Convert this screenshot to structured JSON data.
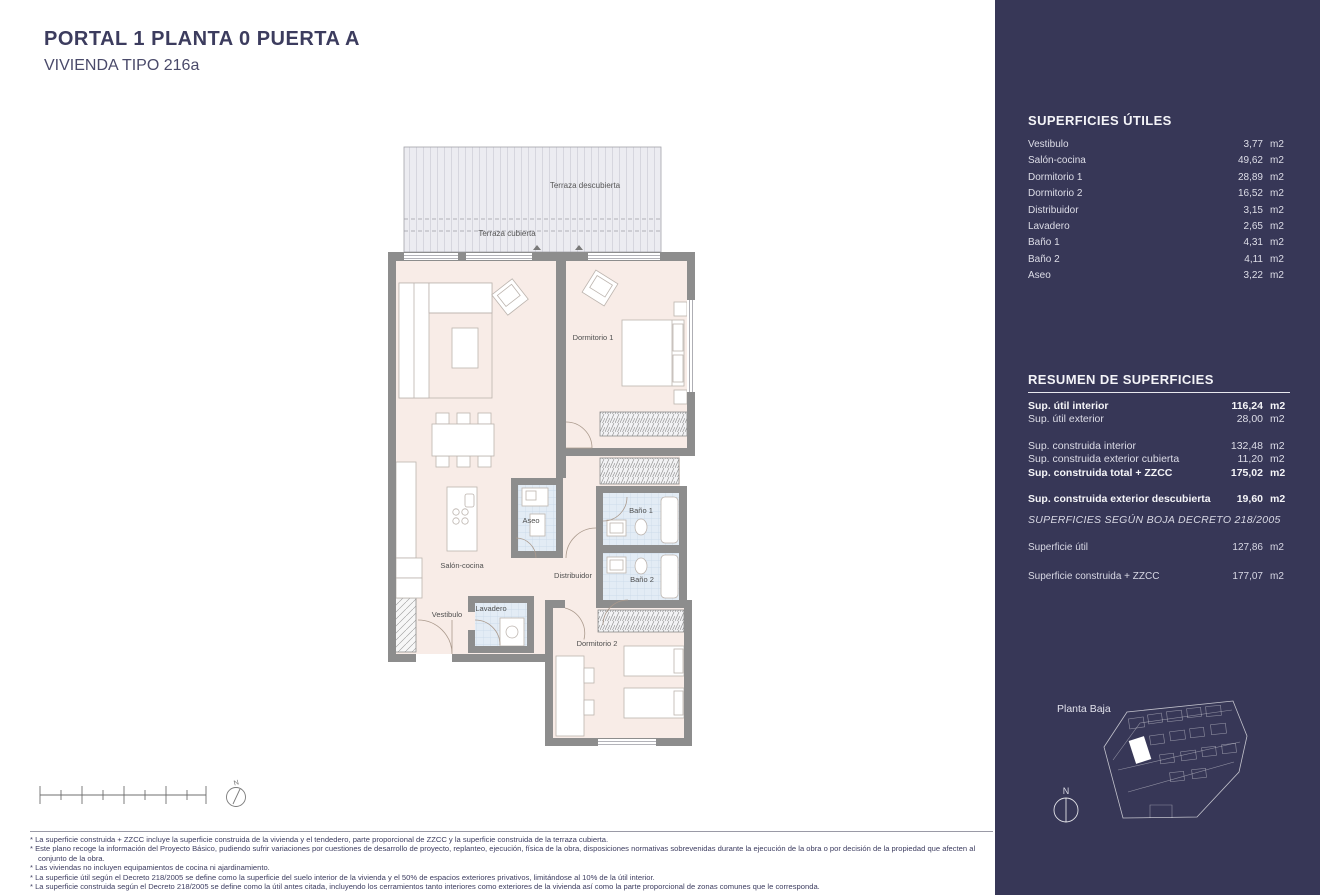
{
  "header": {
    "title": "PORTAL 1  PLANTA 0 PUERTA A",
    "subtitle": "VIVIENDA TIPO 216a"
  },
  "plan": {
    "labels": {
      "terraza_descubierta": "Terraza descubierta",
      "terraza_cubierta": "Terraza cubierta",
      "salon_cocina": "Salón-cocina",
      "dormitorio1": "Dormitorio 1",
      "dormitorio2": "Dormitorio 2",
      "distribuidor": "Distribuidor",
      "bano1": "Baño 1",
      "bano2": "Baño 2",
      "aseo": "Aseo",
      "vestibulo": "Vestibulo",
      "lavadero": "Lavadero"
    },
    "compass_n": "N"
  },
  "sidebar": {
    "superficies_utiles": {
      "title": "SUPERFICIES ÚTILES",
      "rows": [
        {
          "label": "Vestibulo",
          "value": "3,77",
          "unit": "m2"
        },
        {
          "label": "Salón-cocina",
          "value": "49,62",
          "unit": "m2"
        },
        {
          "label": "Dormitorio 1",
          "value": "28,89",
          "unit": "m2"
        },
        {
          "label": "Dormitorio 2",
          "value": "16,52",
          "unit": "m2"
        },
        {
          "label": "Distribuidor",
          "value": "3,15",
          "unit": "m2"
        },
        {
          "label": "Lavadero",
          "value": "2,65",
          "unit": "m2"
        },
        {
          "label": "Baño 1",
          "value": "4,31",
          "unit": "m2"
        },
        {
          "label": "Baño 2",
          "value": "4,11",
          "unit": "m2"
        },
        {
          "label": "Aseo",
          "value": "3,22",
          "unit": "m2"
        }
      ]
    },
    "resumen": {
      "title": "RESUMEN DE SUPERFICIES",
      "rows": [
        {
          "label": "Sup. útil interior",
          "value": "116,24",
          "unit": "m2"
        },
        {
          "label": "Sup. útil exterior",
          "value": "28,00",
          "unit": "m2"
        },
        {
          "label": "Sup. construida interior",
          "value": "132,48",
          "unit": "m2"
        },
        {
          "label": "Sup. construida exterior cubierta",
          "value": "11,20",
          "unit": "m2"
        },
        {
          "label": "Sup. construida total + ZZCC",
          "value": "175,02",
          "unit": "m2"
        }
      ],
      "descubierta": {
        "label": "Sup. construida exterior descubierta",
        "value": "19,60",
        "unit": "m2"
      }
    },
    "boja": {
      "title": "SUPERFICIES SEGÚN BOJA DECRETO 218/2005",
      "rows": [
        {
          "label": "Superficie útil",
          "value": "127,86",
          "unit": "m2"
        },
        {
          "label": "Superficie construida + ZZCC",
          "value": "177,07",
          "unit": "m2"
        }
      ]
    },
    "minimap": {
      "label": "Planta Baja",
      "compass_n": "N"
    }
  },
  "footnotes": [
    "* La superficie construida + ZZCC incluye la superficie construida de la vivienda y el tendedero, parte proporcional de ZZCC y la superficie construida de la terraza cubierta.",
    "* Este plano recoge la información del Proyecto Básico, pudiendo sufrir variaciones por cuestiones de desarrollo de proyecto, replanteo, ejecución, física de la obra, disposiciones normativas sobrevenidas durante la ejecución de la obra o por decisión de la propiedad que afecten al conjunto de la obra.",
    "* Las viviendas no incluyen equipamientos de cocina ni ajardinamiento.",
    "* La superficie útil según el Decreto 218/2005 se define como la superficie del suelo interior de la vivienda y el 50% de espacios exteriores privativos, limitándose al 10% de la útil interior.",
    "* La superficie construida según el Decreto 218/2005 se define como la útil antes citada, incluyendo los cerramientos tanto interiores como exteriores de la vivienda así como la parte proporcional de zonas comunes que le corresponda."
  ],
  "colors": {
    "sidebar_bg": "#373757",
    "title_text": "#3c3c5e",
    "room_fill": "#f8ece7",
    "wet_room_fill": "#e3ecf5",
    "terrace_fill": "#ececf1",
    "wall": "#8d8d8d"
  }
}
